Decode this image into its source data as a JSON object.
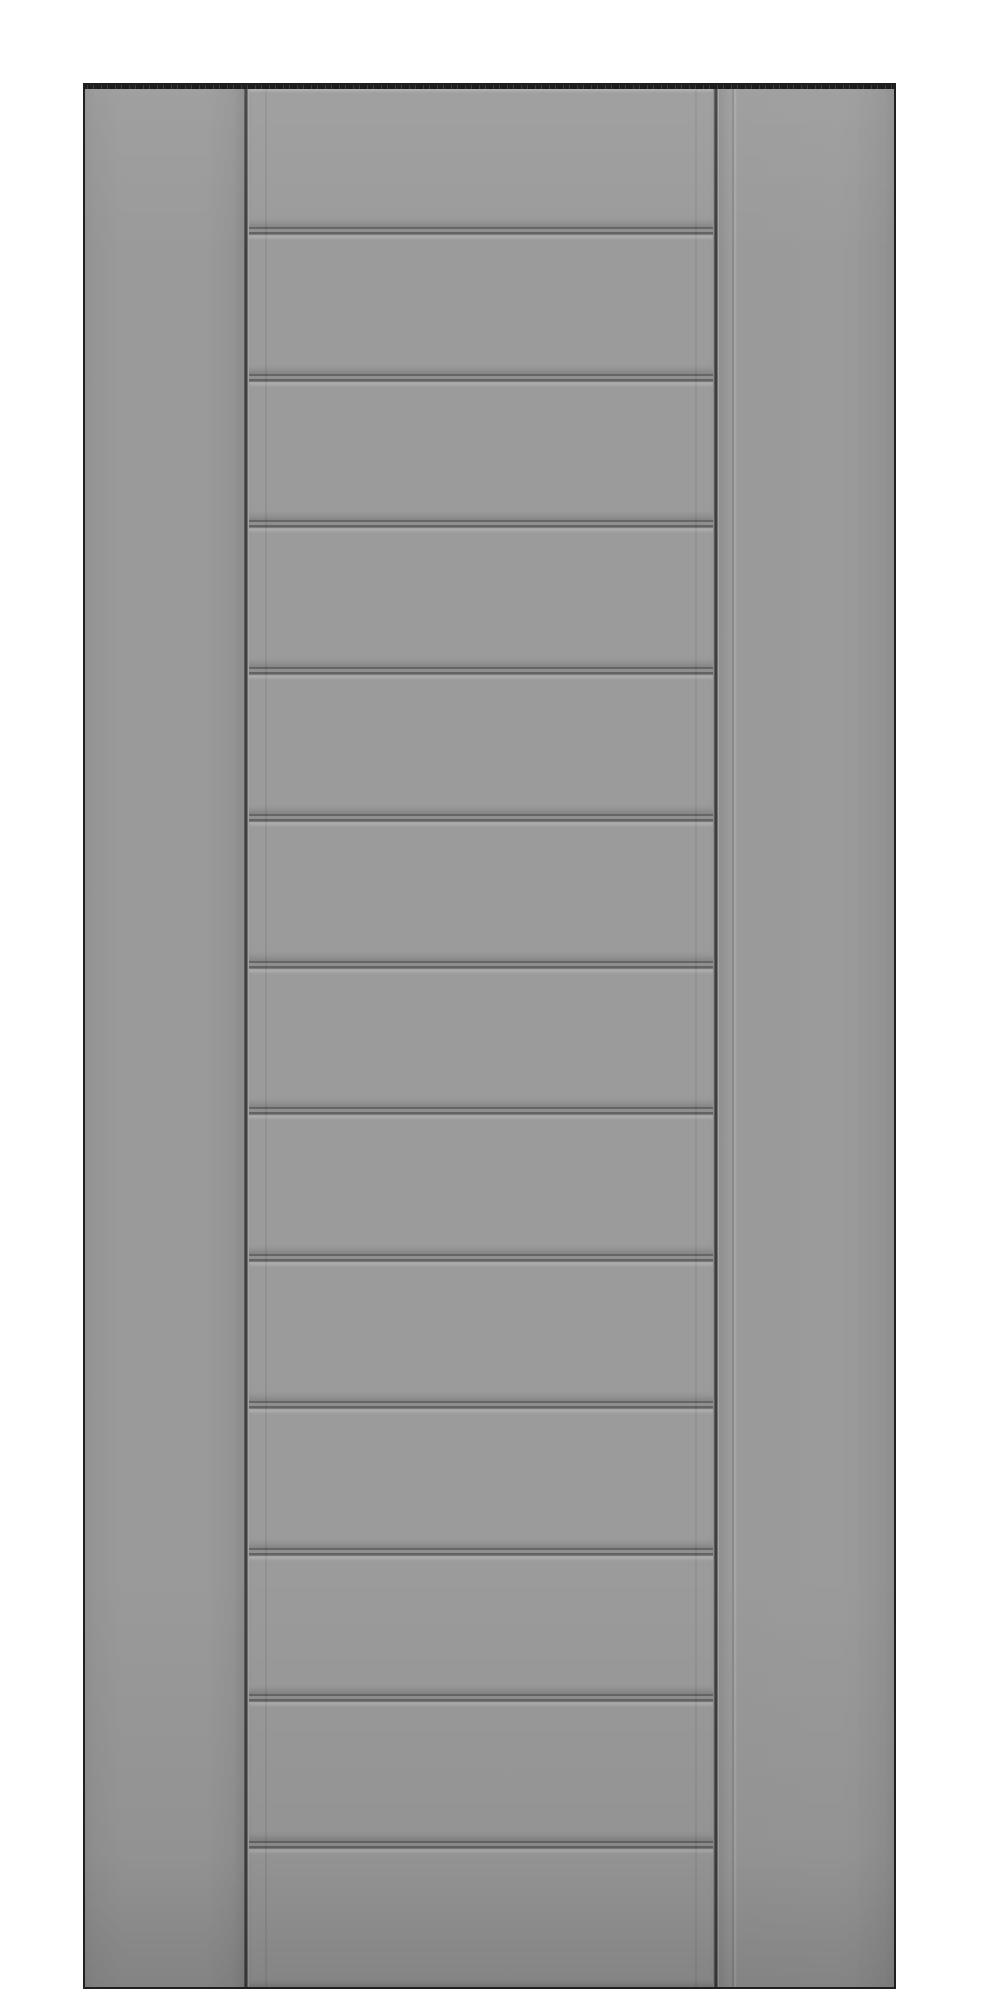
{
  "scene": {
    "type": "product-photo",
    "subject": "Flat gray interior door slab, shown full-height on a white background, with plain left and right stiles and a recessed center section of horizontal shiplap planks",
    "background_color": "#ffffff"
  },
  "door": {
    "plank_count": 13,
    "plank_groove_count": 12,
    "style": "horizontal shiplap plank center panel between plain stiles",
    "hardware": "none visible",
    "colors": {
      "bg": "#ffffff",
      "base": "#9a9a9a",
      "plank": "#9b9b9b",
      "edge": "#202020",
      "top-edge": "#1c1c1c",
      "groove-dark": "#3e3e3e",
      "plank-groove": "#666666",
      "groove-gap": "#8f8f8f",
      "highlight": "#a4a4a4"
    }
  }
}
